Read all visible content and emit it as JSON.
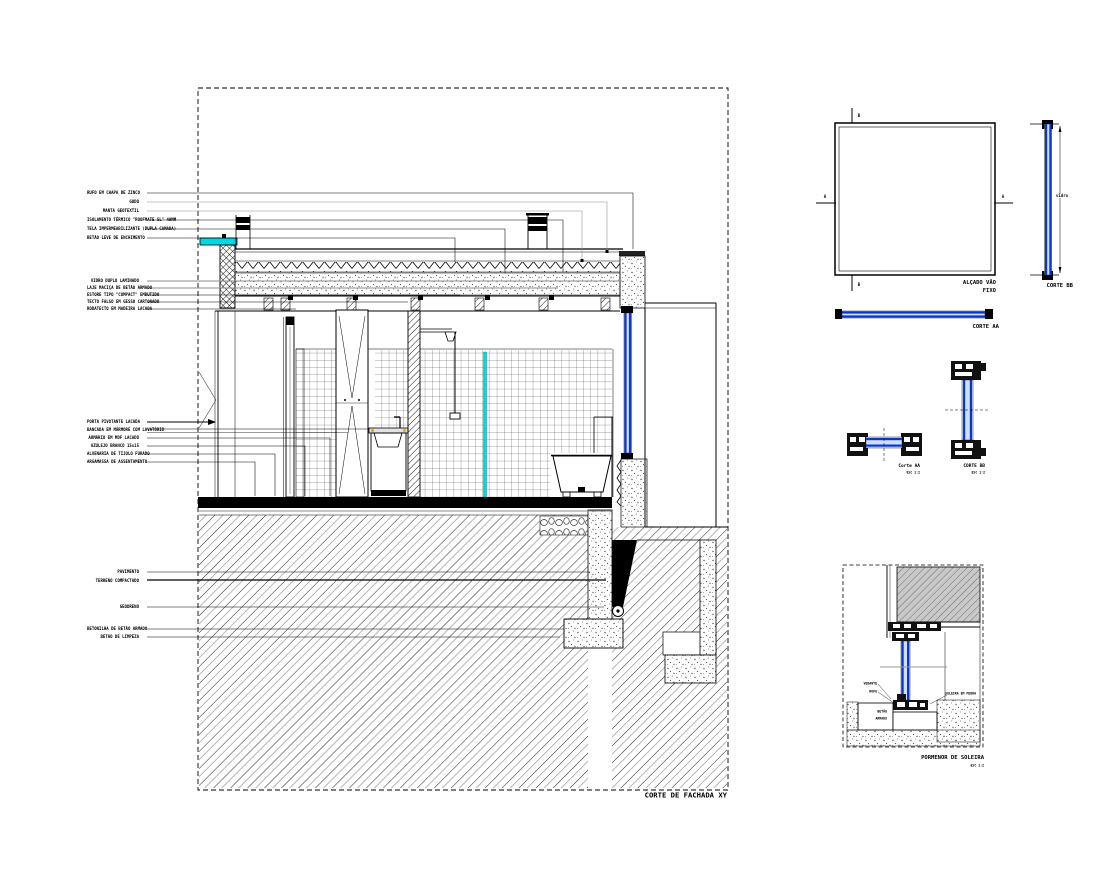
{
  "titles": {
    "main": "CORTE DE FACHADA XY",
    "elevation_1": "ALÇADO VÃO",
    "elevation_2": "FIXO",
    "corte_bb_strip": "CORTE BB",
    "corte_aa_strip": "CORTE AA",
    "detail_aa": "Corte AA",
    "detail_aa_scale": "ESC 1:2",
    "detail_bb": "CORTE BB",
    "detail_bb_scale": "ESC 1:2",
    "sill": "PORMENOR DE SOLEIRA",
    "sill_scale": "ESC 1:2",
    "dim_glass": "vidro",
    "marker_a": "A",
    "marker_b": "B"
  },
  "labels": {
    "roof": [
      "RUFO EM CHAPA DE ZINCO",
      "GODO",
      "MANTA GEOTEXTIL",
      "ISOLAMENTO TÉRMICO \"ROOFMATE SL\" 40MM",
      "TELA IMPERMEABILIZANTE (DUPLA CAMADA)",
      "BETÃO LEVE DE ENCHIMENTO"
    ],
    "ceiling": [
      "VIDRO DUPLO LAMINADO",
      "LAJE MACIÇA DE BETÃO ARMADO",
      "ESTORE TIPO \"COMPACT\" EMBUTIDO",
      "TECTO FALSO EM GESSO CARTONADO",
      "RODATECTO EM MADEIRA LACADA"
    ],
    "interior": [
      "PORTA PIVOTANTE LACADA",
      "BANCADA EM MÁRMORE COM LAVATÓRIO",
      "ARMÁRIO EM MDF LACADO",
      "AZULEJO BRANCO 15x15",
      "ALVENARIA DE TIJOLO FURADO",
      "ARGAMASSA DE ASSENTAMENTO"
    ],
    "ground": [
      "PAVIMENTO",
      "TERRENO COMPACTADO",
      "GEODRENO",
      "BETONILHA DE BETÃO ARMADO",
      "BETÃO DE LIMPEZA"
    ],
    "sill_notes": [
      "VEDANTE",
      "RUFO",
      "SOLEIRA EM PEDRA",
      "BETÃO",
      "ARMADO"
    ]
  },
  "colors": {
    "accent_cyan": "#00D9E3",
    "glazing_blue": "#0A35CF",
    "glazing_light": "#CFE0FF",
    "counter_orange": "#FFA500",
    "leader_gray": "#8C8C8C"
  }
}
